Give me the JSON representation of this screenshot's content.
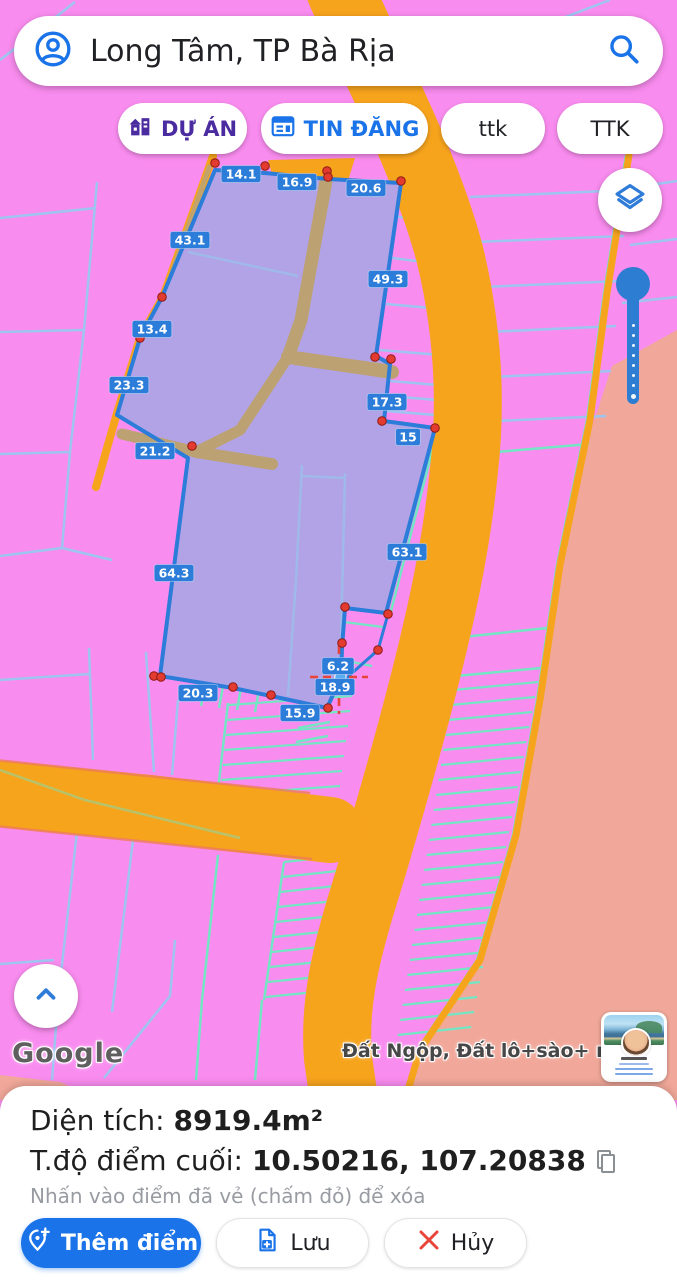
{
  "search": {
    "query": "Long Tâm, TP Bà Rịa"
  },
  "filters": [
    {
      "label": "DỰ ÁN"
    },
    {
      "label": "TIN ĐĂNG"
    },
    {
      "label": "ttk"
    },
    {
      "label": "TTK"
    }
  ],
  "map": {
    "attribution": "Google",
    "overlay_label": "Đất Ngộp, Đất lô+sào+ mẫu",
    "measurements": [
      {
        "label": "14.1",
        "x": 241,
        "y": 174
      },
      {
        "label": "16.9",
        "x": 297,
        "y": 182
      },
      {
        "label": "20.6",
        "x": 366,
        "y": 188
      },
      {
        "label": "43.1",
        "x": 190,
        "y": 240
      },
      {
        "label": "49.3",
        "x": 388,
        "y": 279
      },
      {
        "label": "13.4",
        "x": 152,
        "y": 329
      },
      {
        "label": "23.3",
        "x": 129,
        "y": 385
      },
      {
        "label": "17.3",
        "x": 387,
        "y": 402
      },
      {
        "label": "15",
        "x": 408,
        "y": 437
      },
      {
        "label": "21.2",
        "x": 155,
        "y": 451
      },
      {
        "label": "63.1",
        "x": 407,
        "y": 552
      },
      {
        "label": "64.3",
        "x": 174,
        "y": 573
      },
      {
        "label": "6.2",
        "x": 338,
        "y": 666
      },
      {
        "label": "18.9",
        "x": 335,
        "y": 687
      },
      {
        "label": "20.3",
        "x": 198,
        "y": 693
      },
      {
        "label": "15.9",
        "x": 300,
        "y": 713
      }
    ],
    "vertex_dots": [
      [
        215,
        163
      ],
      [
        265,
        166
      ],
      [
        327,
        171
      ],
      [
        328,
        177
      ],
      [
        401,
        181
      ],
      [
        162,
        297
      ],
      [
        140,
        338
      ],
      [
        192,
        446
      ],
      [
        375,
        357
      ],
      [
        391,
        359
      ],
      [
        382,
        421
      ],
      [
        435,
        428
      ],
      [
        345,
        607
      ],
      [
        388,
        614
      ],
      [
        342,
        643
      ],
      [
        378,
        650
      ],
      [
        154,
        676
      ],
      [
        161,
        677
      ],
      [
        233,
        687
      ],
      [
        271,
        695
      ],
      [
        328,
        708
      ]
    ],
    "last_point": {
      "x": 339,
      "y": 677
    }
  },
  "info_panel": {
    "area_label": "Diện tích:",
    "area_value": "8919.4m²",
    "coord_label": "T.độ điểm cuối:",
    "coord_value": "10.50216, 107.20838",
    "hint": "Nhấn vào điểm đã vẻ (chấm đỏ) để xóa"
  },
  "actions": {
    "add_point": "Thêm điểm",
    "save": "Lưu",
    "cancel": "Hủy"
  },
  "colors": {
    "accent_blue": "#1A73E8",
    "measure_blue": "#2C7CD9",
    "road_orange": "#F7A41D",
    "parcel_pink": "#F98CEF",
    "parcel_line_blue": "#9EC5F0",
    "parcel_line_teal": "#73E6C4",
    "selection_purple": "#B2A3E6",
    "salmon_zone": "#F1A89A",
    "dot_red": "#E33B30",
    "project_purple": "#4B2BA0",
    "cancel_red": "#E8443A"
  }
}
